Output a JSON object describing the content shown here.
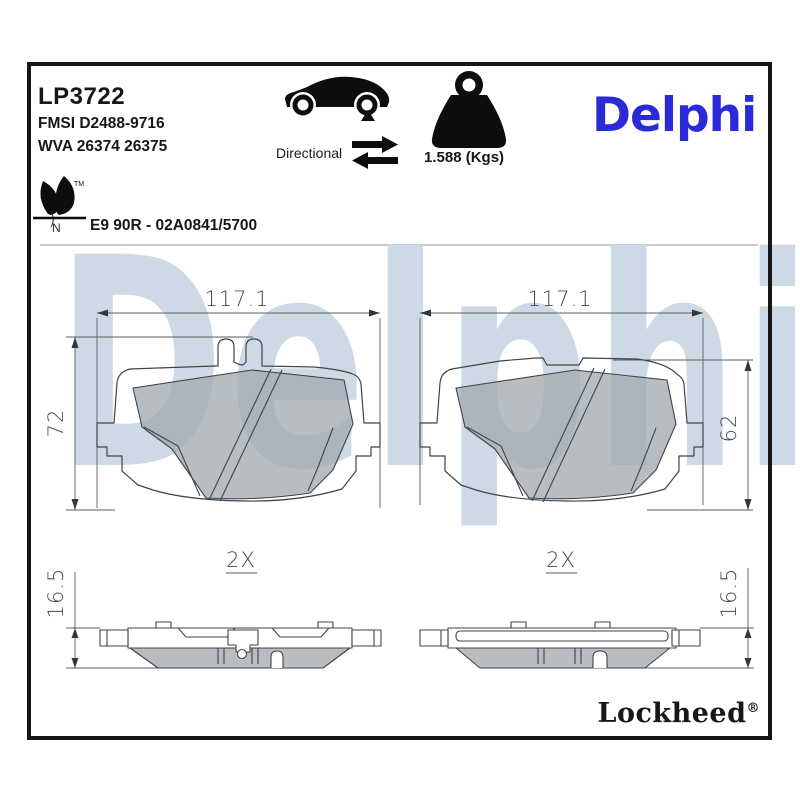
{
  "header": {
    "part_number": "LP3722",
    "fmsi": "FMSI D2488-9716",
    "wva": "WVA 26374 26375",
    "directional_label": "Directional",
    "weight_label": "1.588 (Kgs)",
    "brand_logo": "Delphi",
    "eco": {
      "tm": "TM",
      "n": "N"
    },
    "approval_code": "E9 90R - 02A0841/5700"
  },
  "watermark_text": "Delphi",
  "drawings": {
    "left_pad_front": {
      "width": "117.1",
      "height": "72"
    },
    "right_pad_front": {
      "width": "117.1",
      "height": "62"
    },
    "left_pad_profile": {
      "quantity": "2X",
      "thickness": "16.5"
    },
    "right_pad_profile": {
      "quantity": "2X",
      "thickness": "16.5"
    }
  },
  "footer": {
    "brand_logo": "Lockheed",
    "registered_mark": "®"
  },
  "colors": {
    "brand_blue": "#2a2ad6",
    "watermark_blue": "#cdd9e4",
    "friction_gray": "#c4c8cc",
    "line_dark": "#3f444a"
  }
}
